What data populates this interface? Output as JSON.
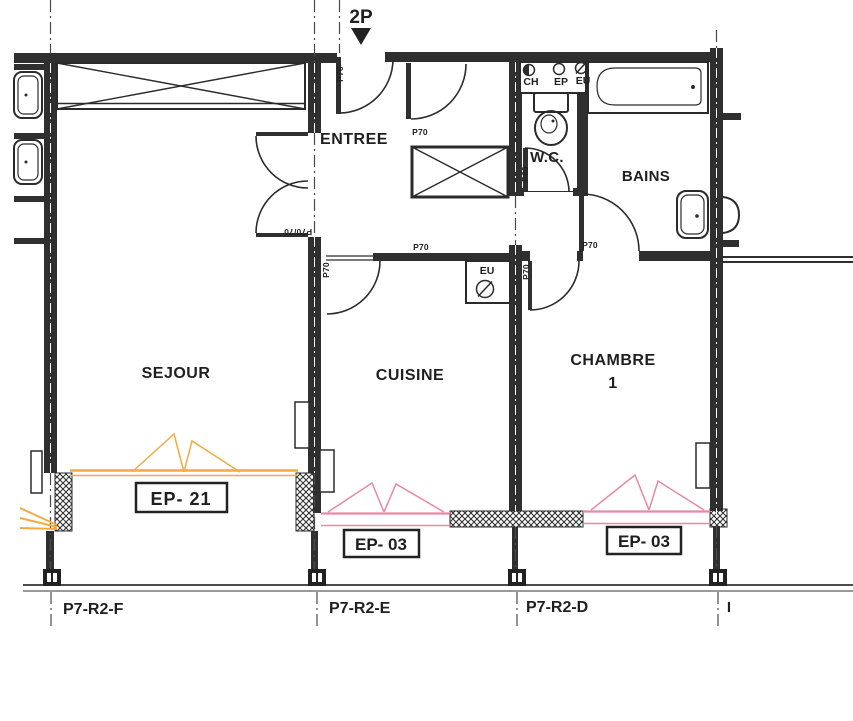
{
  "plan": {
    "unit_label": "2P",
    "rooms": {
      "sejour": "SEJOUR",
      "entree": "ENTREE",
      "wc": "W.C.",
      "bains": "BAINS",
      "cuisine": "CUISINE",
      "chambre": "CHAMBRE",
      "chambre_number": "1"
    },
    "window_tags": {
      "sejour": "EP- 21",
      "cuisine": "EP- 03",
      "chambre": "EP- 03"
    },
    "door_tags": {
      "entrance": "P70",
      "hall_closet": "P70",
      "corridor": "P70",
      "cuisine": "P70",
      "chambre": "P70",
      "bains": "P70",
      "sejour_double": "P70/70",
      "wc": "P60"
    },
    "duct_labels": {
      "ch": "CH",
      "ep": "EP",
      "eu": "EU",
      "cuisine_eu": "EU"
    },
    "grid_labels": {
      "f": "P7-R2-F",
      "e": "P7-R2-E",
      "d": "P7-R2-D",
      "right_tick": "I"
    },
    "colors": {
      "ink": "#2b2b2b",
      "wall": "#2f2f2f",
      "sejour_window": "#f0ac40",
      "secondary_window": "#e789a4"
    }
  }
}
